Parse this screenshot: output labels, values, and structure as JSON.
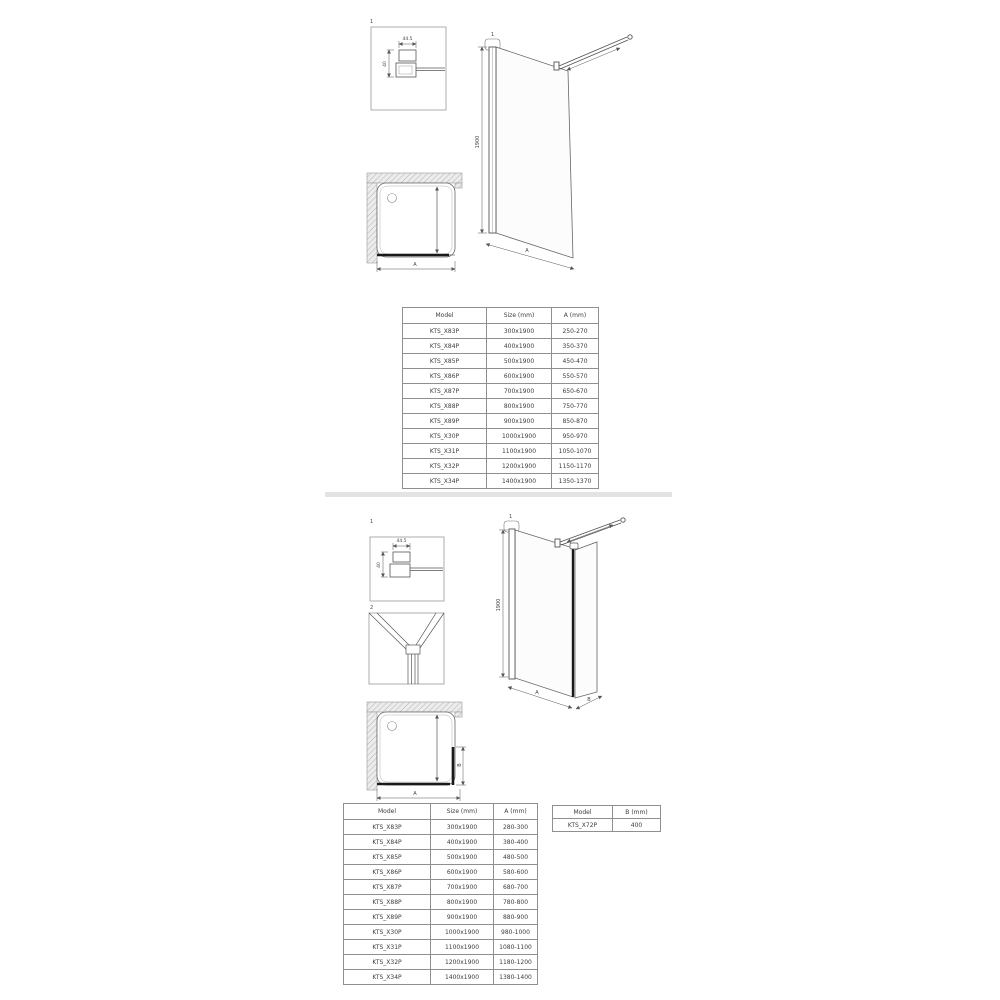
{
  "divider": {
    "color": "#e3e3e3"
  },
  "top_section": {
    "detail_box_1": {
      "label": "1",
      "width_dim": "44.5",
      "height_dim": "40"
    },
    "front_view": {
      "callout": "1",
      "height_dim": "1900",
      "width_dim": "A"
    },
    "plan_view": {
      "width_dim": "A"
    },
    "table": {
      "headers": [
        "Model",
        "Size (mm)",
        "A (mm)"
      ],
      "rows": [
        [
          "KTS_X83P",
          "300x1900",
          "250-270"
        ],
        [
          "KTS_X84P",
          "400x1900",
          "350-370"
        ],
        [
          "KTS_X85P",
          "500x1900",
          "450-470"
        ],
        [
          "KTS_X86P",
          "600x1900",
          "550-570"
        ],
        [
          "KTS_X87P",
          "700x1900",
          "650-670"
        ],
        [
          "KTS_X88P",
          "800x1900",
          "750-770"
        ],
        [
          "KTS_X89P",
          "900x1900",
          "850-870"
        ],
        [
          "KTS_X30P",
          "1000x1900",
          "950-970"
        ],
        [
          "KTS_X31P",
          "1100x1900",
          "1050-1070"
        ],
        [
          "KTS_X32P",
          "1200x1900",
          "1150-1170"
        ],
        [
          "KTS_X34P",
          "1400x1900",
          "1350-1370"
        ]
      ]
    }
  },
  "bottom_section": {
    "detail_box_1": {
      "label": "1",
      "width_dim": "44.5",
      "height_dim": "40"
    },
    "detail_box_2": {
      "label": "2"
    },
    "perspective_view": {
      "callout": "1",
      "height_dim": "1900",
      "width_dim": "A",
      "depth_dim": "B"
    },
    "plan_view": {
      "width_dim": "A",
      "depth_dim": "B"
    },
    "table": {
      "headers": [
        "Model",
        "Size (mm)",
        "A (mm)"
      ],
      "rows": [
        [
          "KTS_X83P",
          "300x1900",
          "280-300"
        ],
        [
          "KTS_X84P",
          "400x1900",
          "380-400"
        ],
        [
          "KTS_X85P",
          "500x1900",
          "480-500"
        ],
        [
          "KTS_X86P",
          "600x1900",
          "580-600"
        ],
        [
          "KTS_X87P",
          "700x1900",
          "680-700"
        ],
        [
          "KTS_X88P",
          "800x1900",
          "780-800"
        ],
        [
          "KTS_X89P",
          "900x1900",
          "880-900"
        ],
        [
          "KTS_X30P",
          "1000x1900",
          "980-1000"
        ],
        [
          "KTS_X31P",
          "1100x1900",
          "1080-1100"
        ],
        [
          "KTS_X32P",
          "1200x1900",
          "1180-1200"
        ],
        [
          "KTS_X34P",
          "1400x1900",
          "1380-1400"
        ]
      ]
    },
    "side_table": {
      "headers": [
        "Model",
        "B (mm)"
      ],
      "rows": [
        [
          "KTS_X72P",
          "400"
        ]
      ]
    }
  }
}
